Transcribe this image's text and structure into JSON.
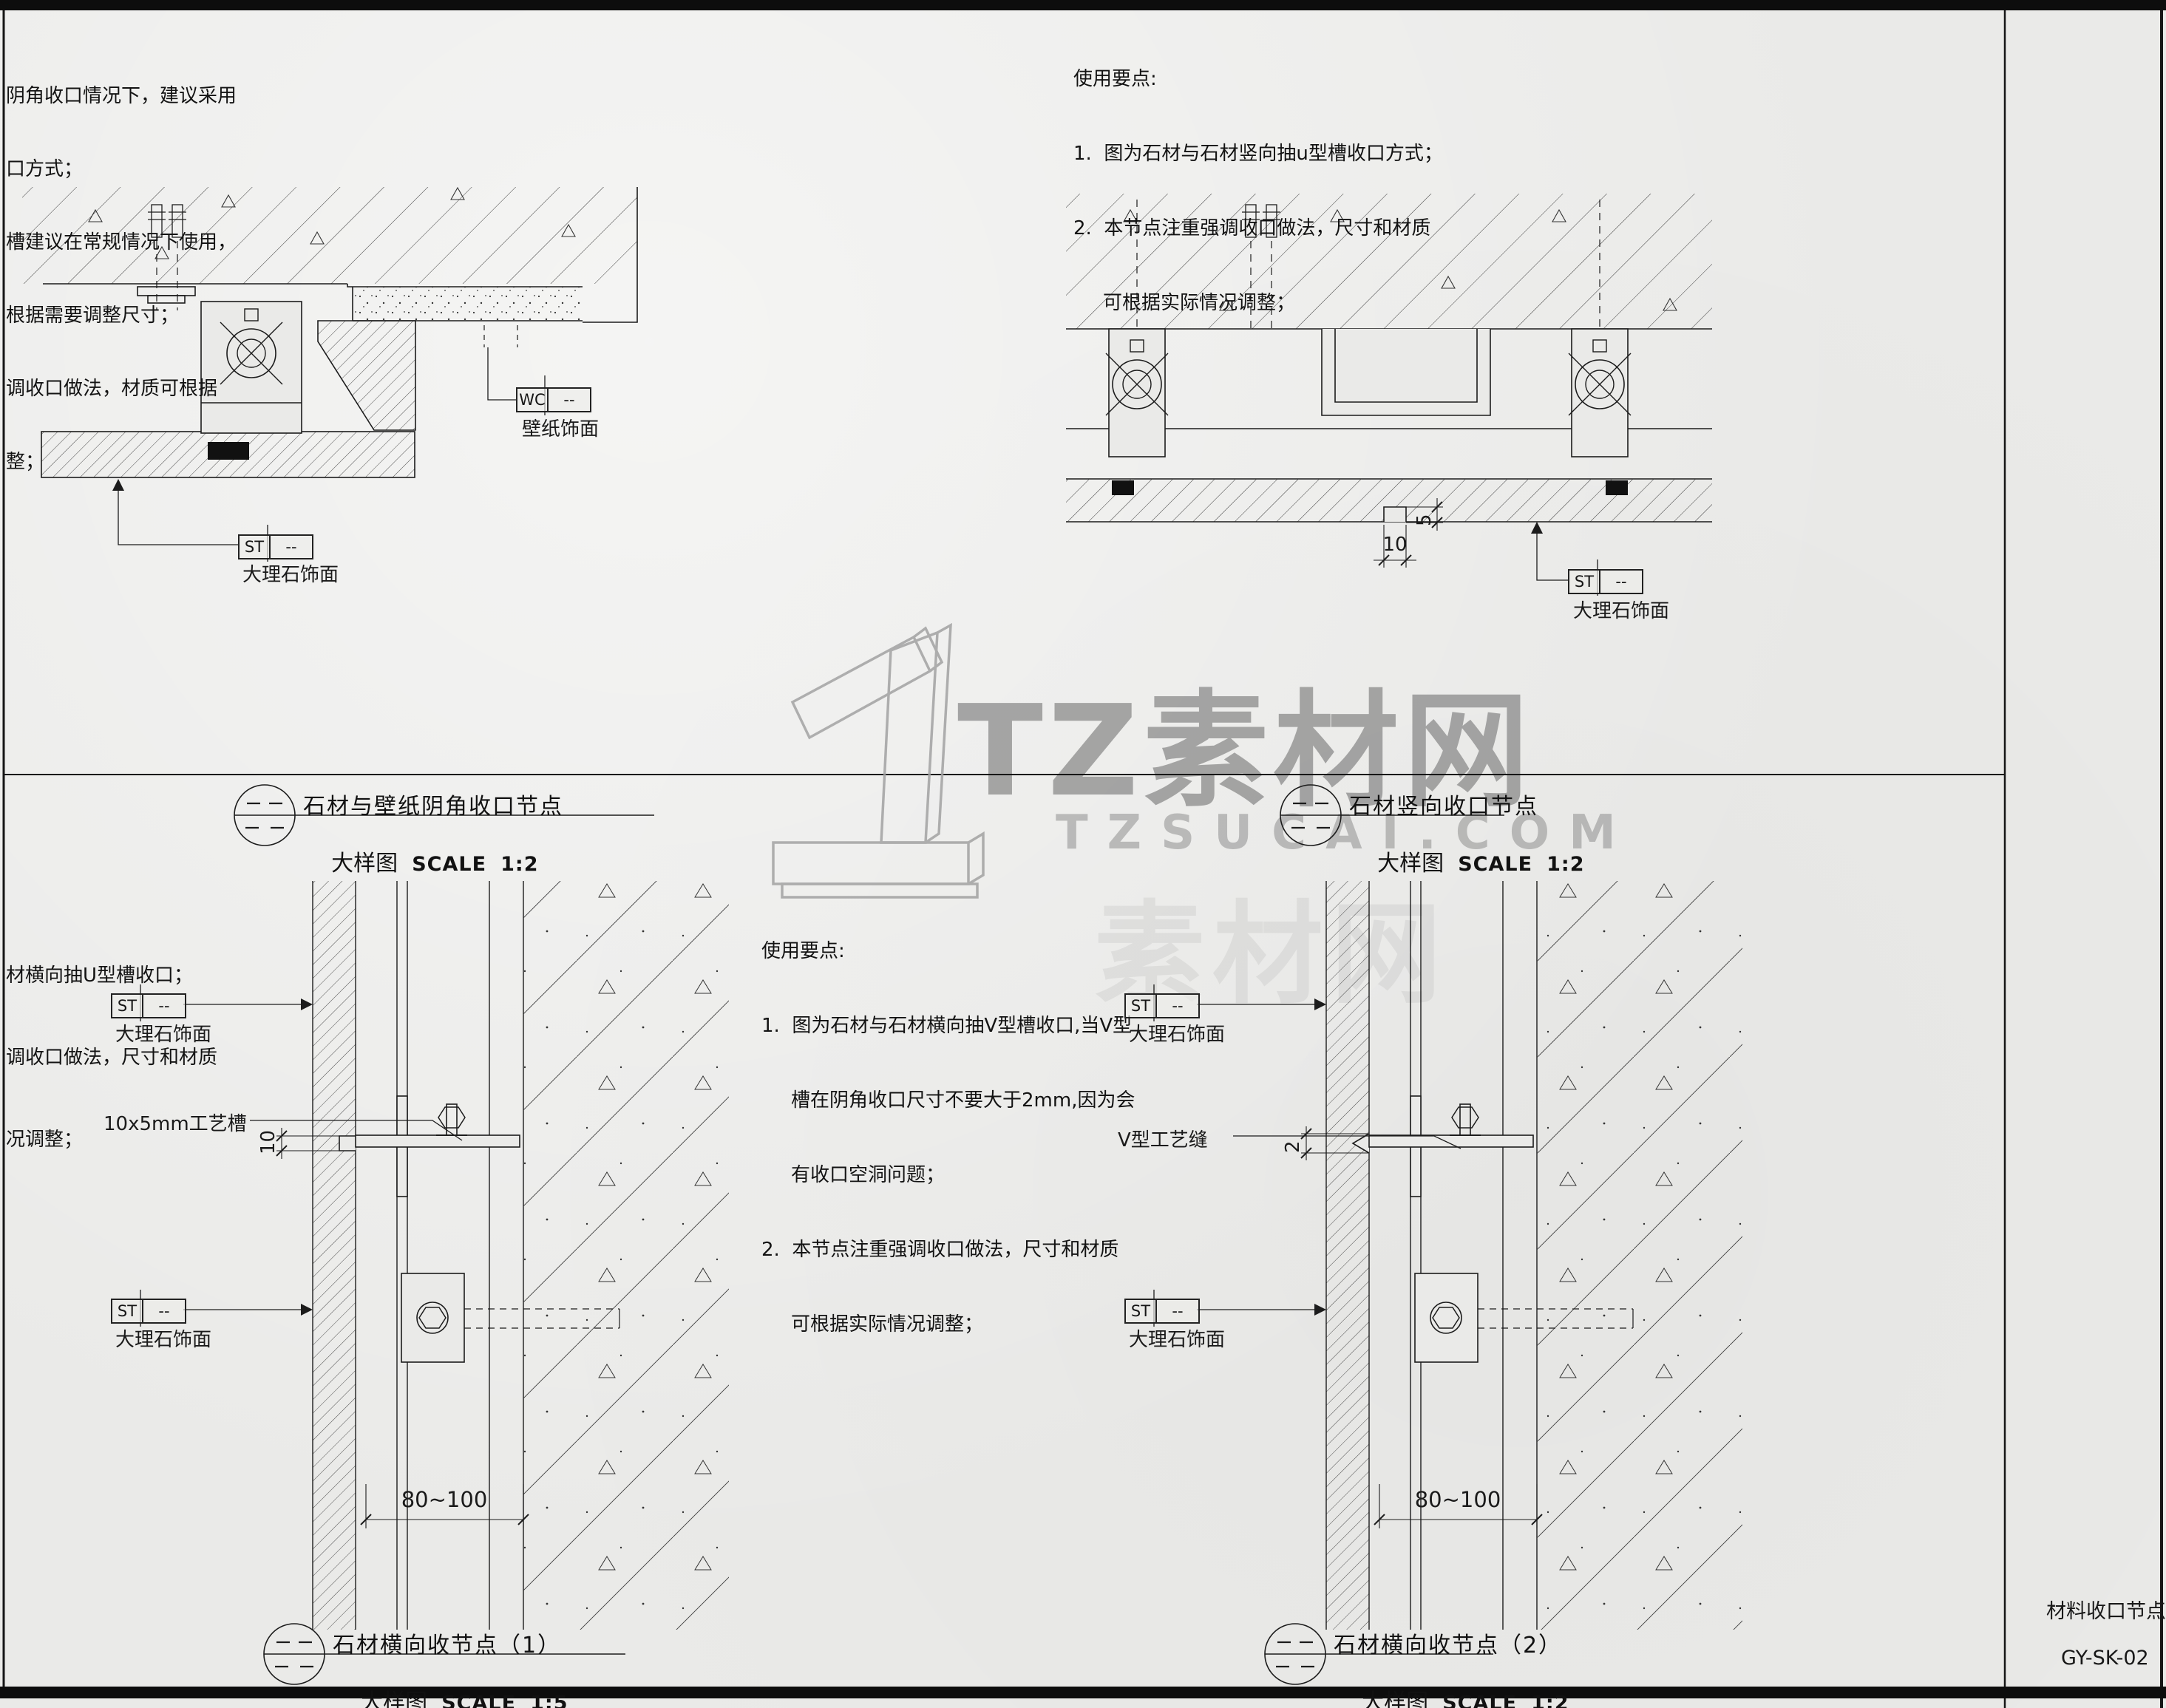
{
  "colors": {
    "paper": "#eaeae8",
    "ink": "#1c1c1c",
    "watermark_gray": "#9b9b9b"
  },
  "notes_top_left": {
    "lines": [
      "阴角收口情况下，建议采用",
      "口方式；",
      "槽建议在常规情况下使用，",
      "根据需要调整尺寸；",
      "调收口做法，材质可根据",
      "整；"
    ]
  },
  "notes_top_right": {
    "heading": "使用要点:",
    "line1": "1.  图为石材与石材竖向抽u型槽收口方式；",
    "line2": "2.  本节点注重强调收口做法，尺寸和材质",
    "line3": "可根据实际情况调整；"
  },
  "notes_bottom_left": {
    "lines": [
      "材横向抽U型槽收口；",
      "调收口做法，尺寸和材质",
      "况调整；"
    ]
  },
  "notes_bottom_mid": {
    "heading": "使用要点:",
    "line1": "1.  图为石材与石材横向抽V型槽收口,当V型",
    "line2": "槽在阴角收口尺寸不要大于2mm,因为会",
    "line3": "有收口空洞问题；",
    "line4": "2.  本节点注重强调收口做法，尺寸和材质",
    "line5": "可根据实际情况调整；"
  },
  "detail_titles": {
    "d1": {
      "name": "石材与壁纸阴角收口节点",
      "type": "大样图",
      "scale_word": "SCALE",
      "scale": "1:2"
    },
    "d2": {
      "name": "石材竖向收口节点",
      "type": "大样图",
      "scale_word": "SCALE",
      "scale": "1:2"
    },
    "d3": {
      "name": "石材横向收节点（1）",
      "type": "大样图",
      "scale_word": "SCALE",
      "scale": "1:5"
    },
    "d4": {
      "name": "石材横向收节点（2）",
      "type": "大样图",
      "scale_word": "SCALE",
      "scale": "1:2"
    }
  },
  "tags": {
    "st": "ST",
    "wc": "WC",
    "dash": "--",
    "marble": "大理石饰面",
    "wallpaper": "壁纸饰面"
  },
  "labels": {
    "groove": "10x5mm工艺槽",
    "vseam": "V型工艺缝"
  },
  "dims": {
    "d10": "10",
    "d5": "5",
    "d2": "2",
    "d80": "80~100"
  },
  "watermark": {
    "brand": "TZ素材网",
    "site": "TZSUCAI.COM",
    "ghost": "素材网"
  },
  "titleblock": {
    "sheet": "材料收口节点-02",
    "code": "GY-SK-02"
  }
}
